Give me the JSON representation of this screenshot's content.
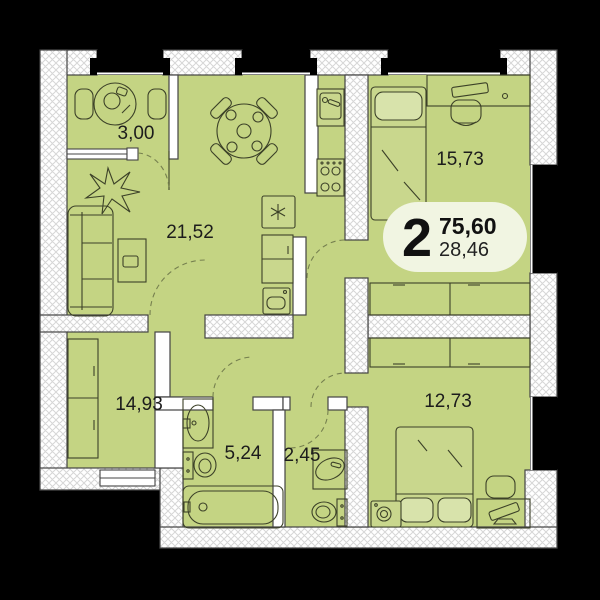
{
  "floor_plan": {
    "title": "2-room apartment floor plan",
    "colors": {
      "background": "#000000",
      "room_fill": "#c4d483",
      "wall_fill": "#ffffff",
      "wall_outline": "#444444",
      "badge_fill": "#f1f5e2",
      "furniture_stroke": "#3c4128"
    },
    "badge": {
      "room_count": "2",
      "total_area": "75,60",
      "secondary_area": "28,46"
    },
    "rooms": {
      "balcony": {
        "area": "3,00"
      },
      "living_room": {
        "area": "21,52"
      },
      "bedroom_top": {
        "area": "15,73"
      },
      "room_left": {
        "area": "14,93"
      },
      "bathroom": {
        "area": "5,24"
      },
      "wc": {
        "area": "2,45"
      },
      "bedroom_bottom": {
        "area": "12,73"
      }
    }
  }
}
